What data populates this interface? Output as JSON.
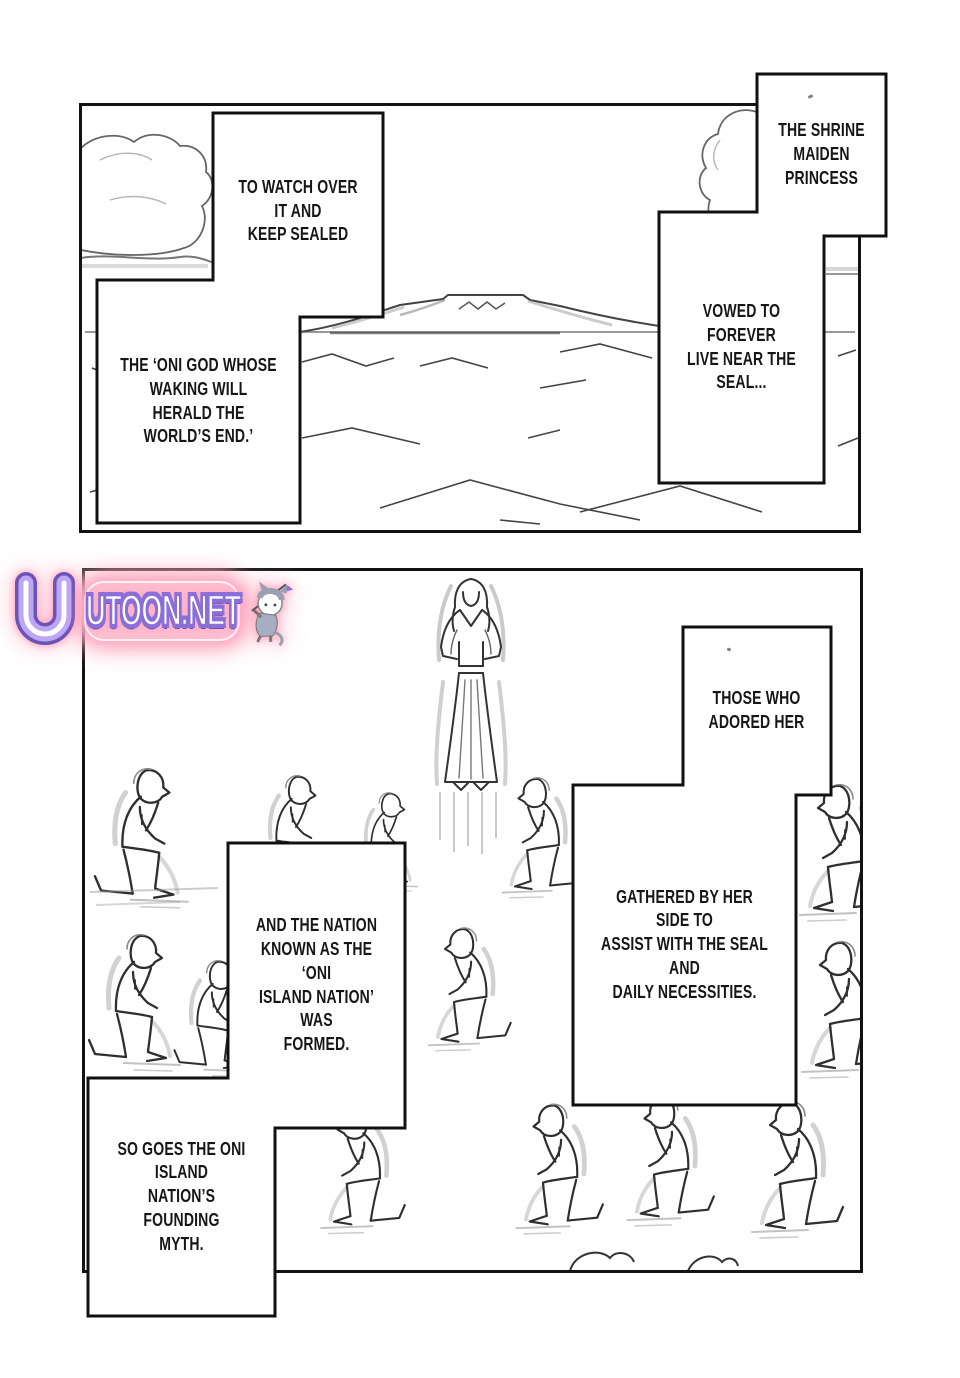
{
  "captions": {
    "to_watch": "TO WATCH OVER IT AND\nKEEP SEALED",
    "oni_god": "THE ‘ONI GOD WHOSE\nWAKING WILL HERALD THE\nWORLD’S END.’",
    "shrine": "THE SHRINE\nMAIDEN\nPRINCESS",
    "vowed": "VOWED TO FOREVER\nLIVE NEAR THE SEAL...",
    "those": "THOSE WHO\nADORED HER",
    "gathered": "GATHERED BY HER SIDE TO\nASSIST WITH THE SEAL AND\nDAILY NECESSITIES.",
    "nation": "AND THE NATION\nKNOWN AS THE ‘ONI\nISLAND NATION’ WAS\nFORMED.",
    "so_goes": "SO GOES THE ONI ISLAND\nNATION’S FOUNDING\nMYTH."
  },
  "watermark": {
    "text": "UTOON.NET",
    "logo_icon": "u-horseshoe-logo",
    "mascot_icon": "cat-mascot"
  },
  "colors": {
    "ink": "#121212",
    "sketch_gray": "#8a8a8a",
    "watermark_purple": "#8b6fd8",
    "watermark_lavender": "#bea6f6",
    "watermark_glow_pink": "#ffaec9",
    "paper": "#ffffff"
  }
}
